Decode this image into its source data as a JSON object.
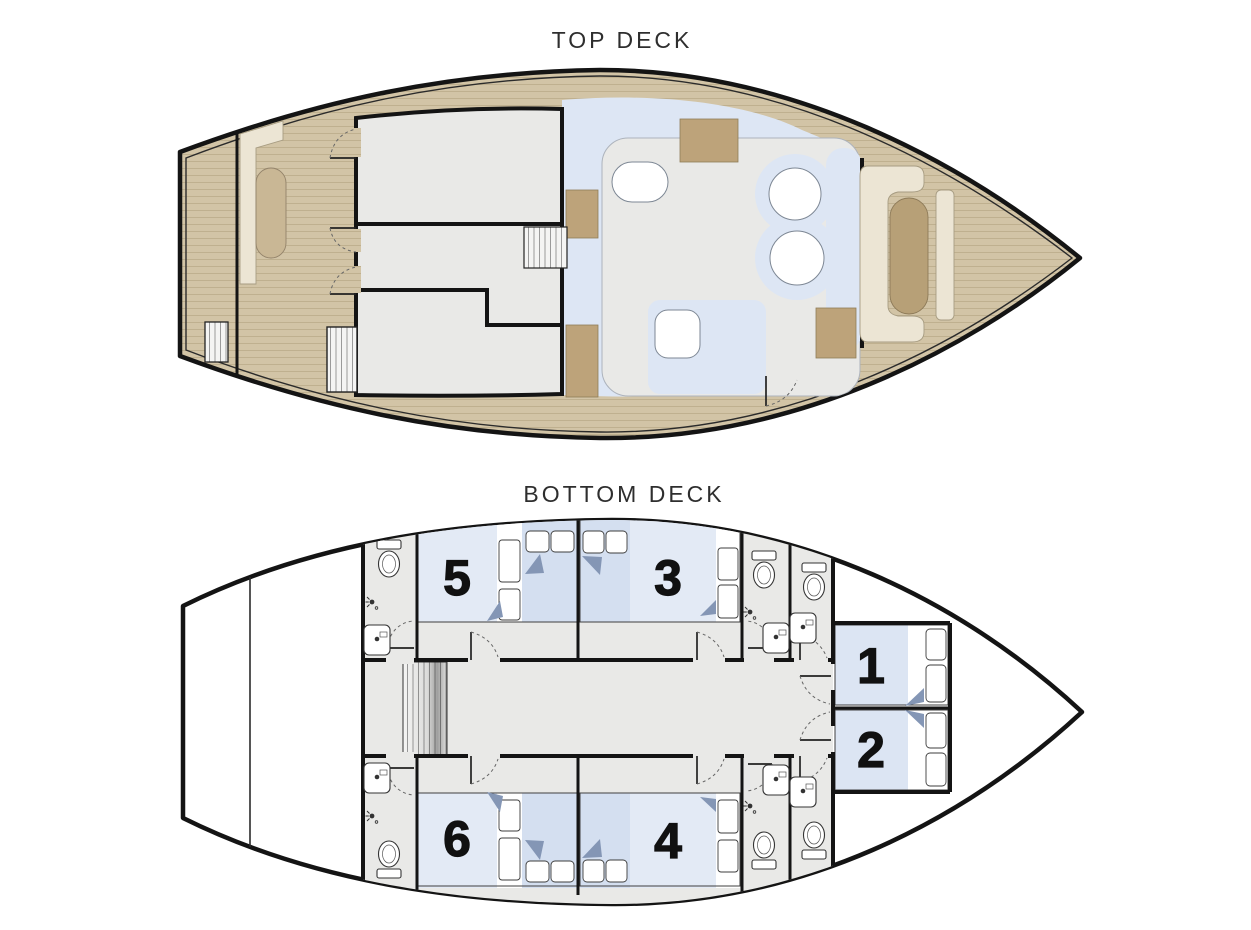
{
  "top_deck": {
    "title": "TOP DECK"
  },
  "bottom_deck": {
    "title": "BOTTOM DECK",
    "cabins": [
      {
        "number": "1"
      },
      {
        "number": "2"
      },
      {
        "number": "3"
      },
      {
        "number": "4"
      },
      {
        "number": "5"
      },
      {
        "number": "6"
      }
    ]
  },
  "colors": {
    "background": "#ffffff",
    "hull_outline": "#141414",
    "wood": "#d2c4a6",
    "wood_line": "#bfb08f",
    "room_floor": "#e9e9e7",
    "seat_blue": "#dde6f4",
    "bed_platform": "#e3eaf5",
    "bed_duvet": "#d4dff0",
    "fold_accent": "#8496b5",
    "cream_bench": "#ece5d4",
    "cabinet_tan": "#bda37a",
    "sunpad_tan": "#b7a077"
  }
}
